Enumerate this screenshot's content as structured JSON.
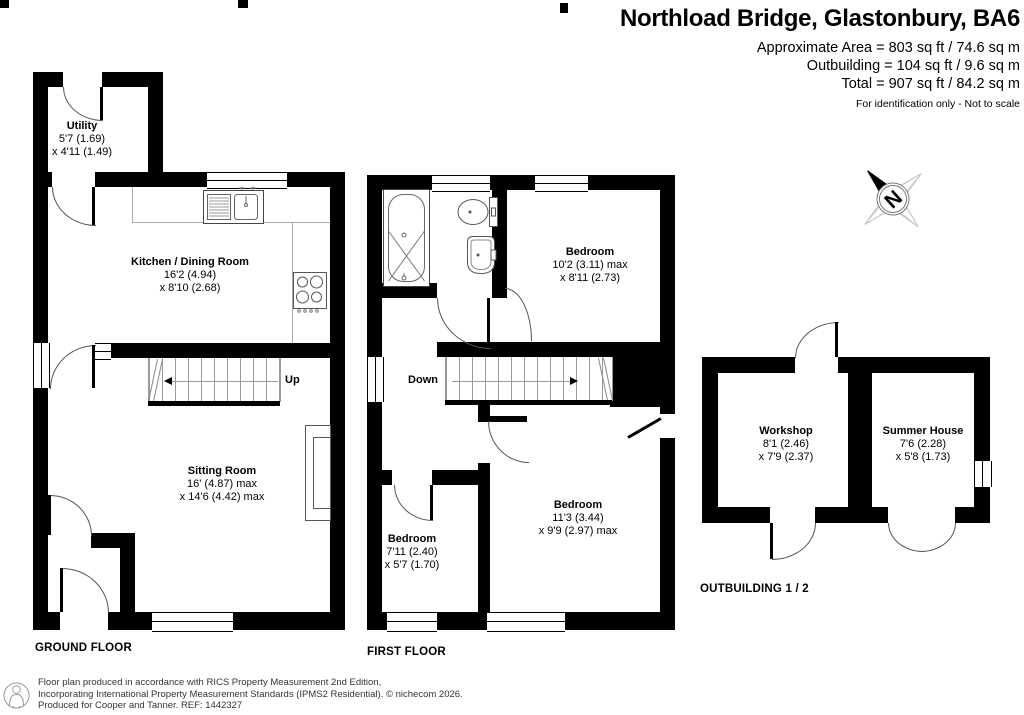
{
  "header": {
    "title": "Northload Bridge, Glastonbury, BA6",
    "area_line1": "Approximate Area = 803 sq ft / 74.6 sq m",
    "area_line2": "Outbuilding = 104 sq ft / 9.6 sq m",
    "area_line3": "Total = 907 sq ft / 84.2 sq m",
    "disclaimer": "For identification only - Not to scale"
  },
  "compass": {
    "label": "N"
  },
  "floors": {
    "ground": {
      "label": "GROUND FLOOR",
      "stairs_label": "Up"
    },
    "first": {
      "label": "FIRST FLOOR",
      "stairs_label": "Down"
    },
    "outbuilding": {
      "label": "OUTBUILDING 1 / 2"
    }
  },
  "rooms": {
    "utility": {
      "name": "Utility",
      "dim1": "5'7 (1.69)",
      "dim2": "x 4'11 (1.49)"
    },
    "kitchen": {
      "name": "Kitchen / Dining Room",
      "dim1": "16'2 (4.94)",
      "dim2": "x 8'10 (2.68)"
    },
    "sitting": {
      "name": "Sitting Room",
      "dim1": "16' (4.87) max",
      "dim2": "x 14'6 (4.42) max"
    },
    "bedroom1": {
      "name": "Bedroom",
      "dim1": "10'2 (3.11) max",
      "dim2": "x 8'11 (2.73)"
    },
    "bedroom2": {
      "name": "Bedroom",
      "dim1": "7'11 (2.40)",
      "dim2": "x 5'7 (1.70)"
    },
    "bedroom3": {
      "name": "Bedroom",
      "dim1": "11'3 (3.44)",
      "dim2": "x 9'9 (2.97) max"
    },
    "workshop": {
      "name": "Workshop",
      "dim1": "8'1 (2.46)",
      "dim2": "x 7'9 (2.37)"
    },
    "summer_house": {
      "name": "Summer House",
      "dim1": "7'6 (2.28)",
      "dim2": "x 5'8 (1.73)"
    }
  },
  "footer": {
    "line1": "Floor plan produced in accordance with RICS Property Measurement 2nd Edition,",
    "line2": "Incorporating International Property Measurement Standards (IPMS2 Residential).   © nichecom 2026.",
    "line3": "Produced for Cooper and Tanner.   REF: 1442327"
  }
}
